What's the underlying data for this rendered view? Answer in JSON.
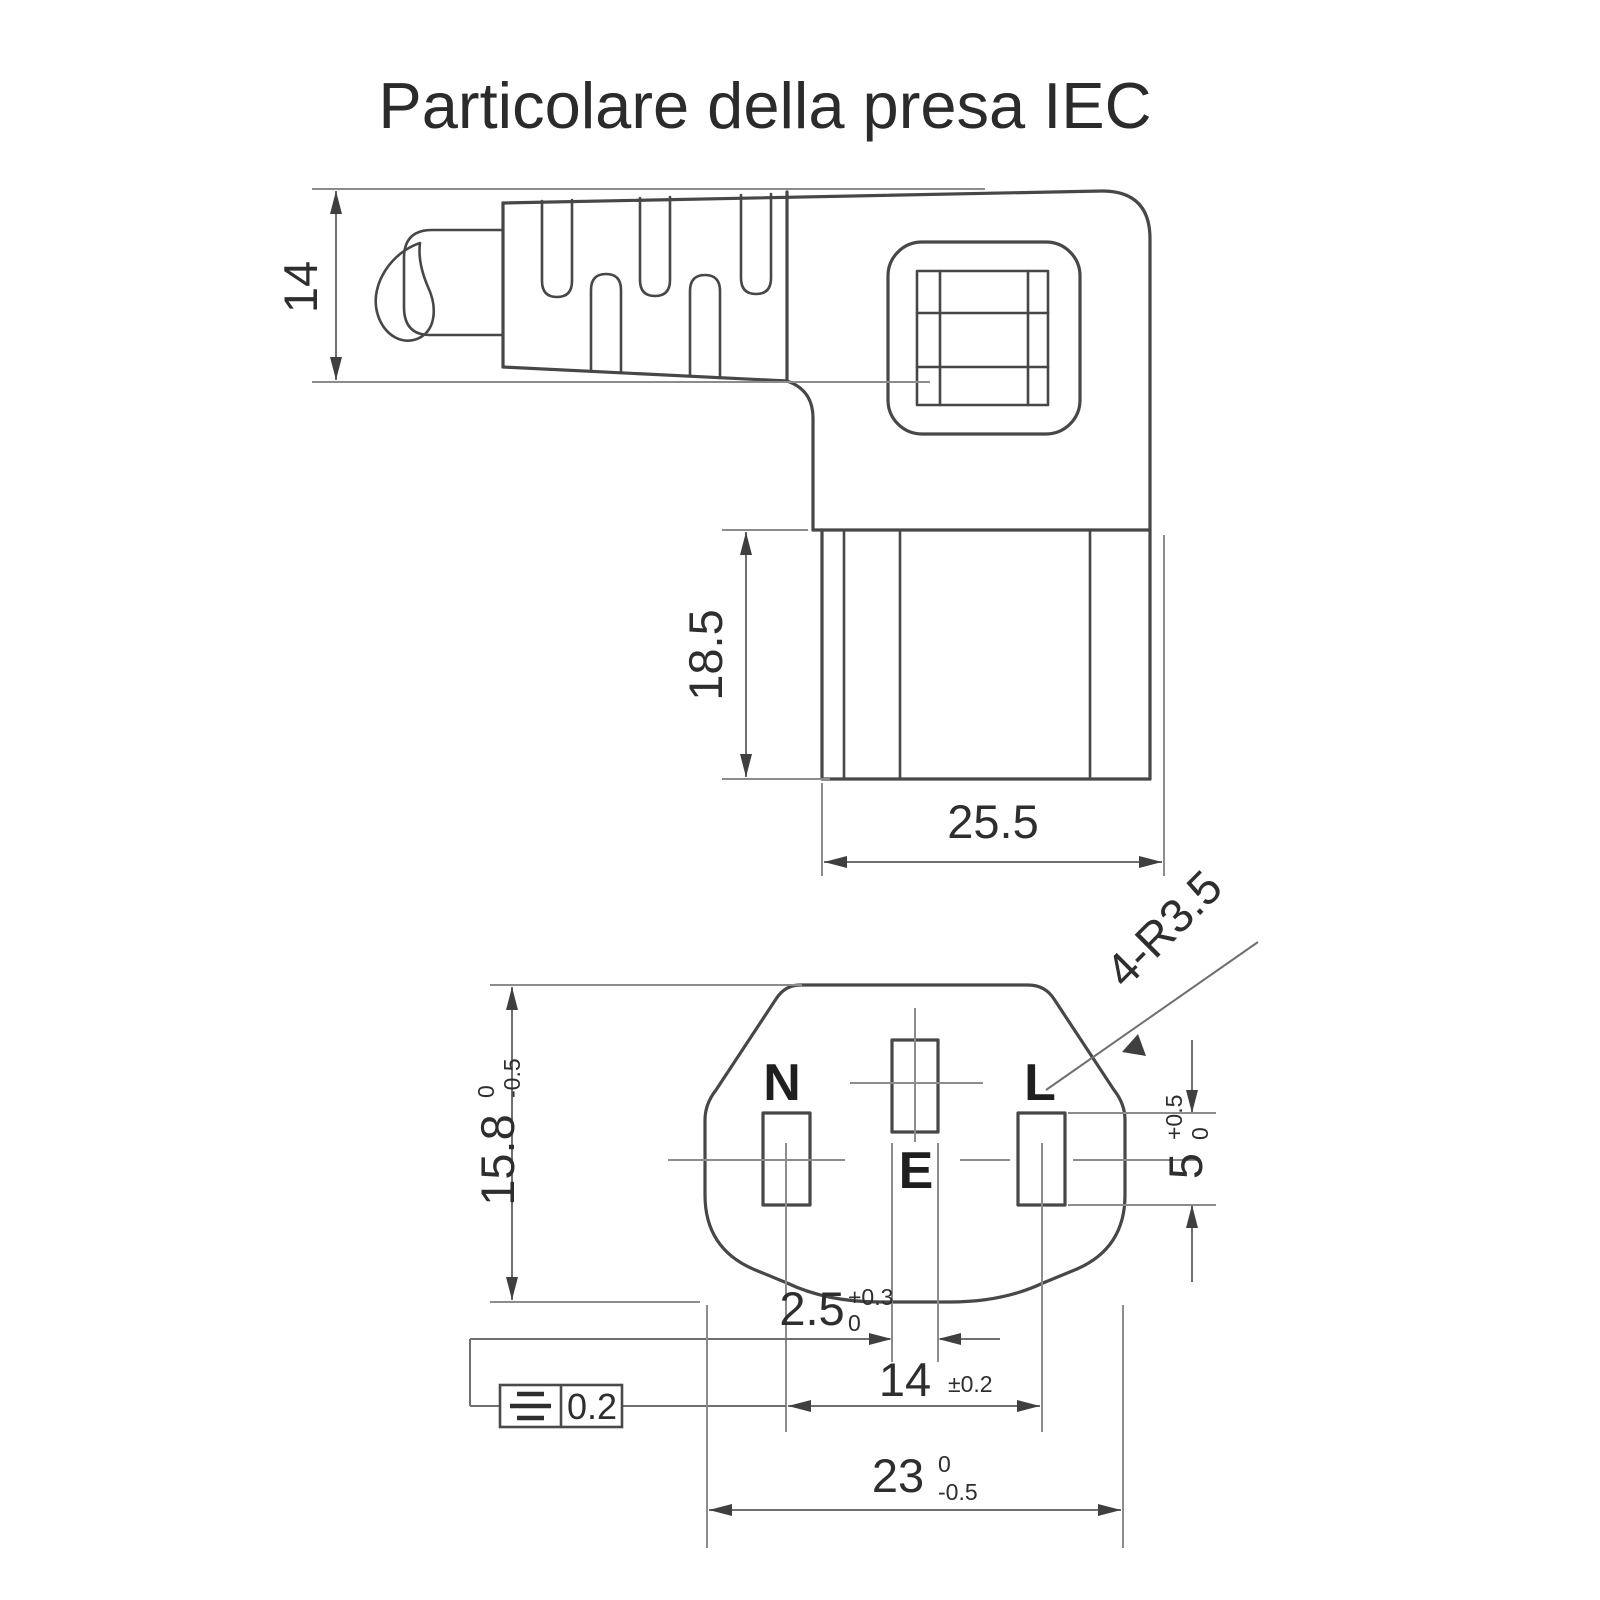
{
  "title": "Particolare della presa IEC",
  "side_view": {
    "dim_cable_height": "14",
    "dim_plug_depth": "18.5",
    "dim_plug_width": "25.5"
  },
  "front_view": {
    "pin_labels": {
      "neutral": "N",
      "earth": "E",
      "live": "L"
    },
    "dim_face_height": {
      "value": "15.8",
      "tol_top": "0",
      "tol_bottom": "-0.5"
    },
    "dim_live_hole_height": {
      "value": "5",
      "tol_top": "+0.5",
      "tol_bottom": "0"
    },
    "dim_earth_hole_width": {
      "value": "2.5",
      "tol_top": "+0.3",
      "tol_bottom": "0"
    },
    "dim_pin_spacing": {
      "value": "14",
      "tolerance": "±0.2"
    },
    "dim_face_width": {
      "value": "23",
      "tol_top": "0",
      "tol_bottom": "-0.5"
    },
    "corner_radius_note": "4-R3.5",
    "symmetry_tolerance": "0.2"
  },
  "colors": {
    "background": "#ffffff",
    "outline": "#474747",
    "dimension": "#6f6f6f",
    "text": "#2e2e2e"
  }
}
